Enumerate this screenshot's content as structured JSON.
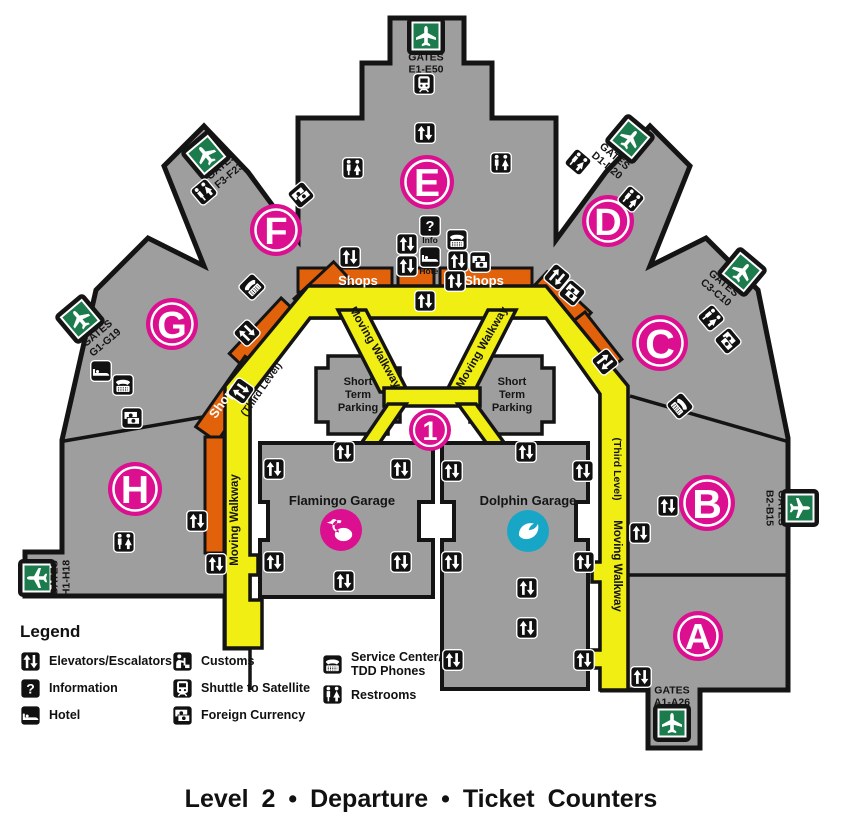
{
  "title": "Level 2 • Departure • Ticket Counters",
  "legend": {
    "heading": "Legend",
    "columns": [
      {
        "items": [
          {
            "label": "Elevators/Escalators",
            "icon": "elevators-escalators-icon",
            "ref": "#ic-elev"
          },
          {
            "label": "Information",
            "icon": "information-icon",
            "ref": "#ic-info"
          },
          {
            "label": "Hotel",
            "icon": "hotel-icon",
            "ref": "#ic-hotel"
          }
        ]
      },
      {
        "items": [
          {
            "label": "Customs",
            "icon": "customs-icon",
            "ref": "#ic-customs"
          },
          {
            "label": "Shuttle to Satellite",
            "icon": "shuttle-to-satellite-icon",
            "ref": "#ic-shuttle"
          },
          {
            "label": "Foreign Currency",
            "icon": "foreign-currency-icon",
            "ref": "#ic-currency"
          }
        ]
      },
      {
        "items": [
          {
            "label": "Service Center/\nTDD Phones",
            "icon": "service-center-tdd-phones-icon",
            "ref": "#ic-service"
          },
          {
            "label": "Restrooms",
            "icon": "restrooms-icon",
            "ref": "#ic-rest"
          }
        ]
      }
    ]
  },
  "map": {
    "colors": {
      "gray": "#9E9E9E",
      "outline": "#141414",
      "pink": "#DB0F8F",
      "gate_green": "#1B7B4D",
      "orange": "#E2610B",
      "yellow": "#F0EE12",
      "teal": "#17A6C6"
    },
    "plane_path": "M 0,-10 C 1.2,-10 1.8,-8.5 1.8,-6.5 L 1.8,-3 L 10,1.5 L 10,4 L 1.8,1.8 L 1.8,6.5 L 4.2,8.3 L 4.2,10.2 L 0,9 L -4.2,10.2 L -4.2,8.3 L -1.8,6.5 L -1.8,1.8 L -10,4 L -10,1.5 L -1.8,-3 L -1.8,-6.5 C -1.8,-8.5 -1.2,-10 0,-10 Z",
    "flamingo_path": "M -2,2.5 C -8,1.5 -10,-3 -7.5,-7 C -5.8,-9.6 -2,-10.6 0.6,-9.2 L -0.8,-6.6 C -3.2,-7.6 -5.4,-6.4 -6.2,-4.2 C -7,-2 -5.4,0 -2.4,0.4 Z M -6.9,-7.9 m -3.1,0 a 3.1,3.1 0 1 0 6.2,0 a 3.1,3.1 0 1 0 -6.2,0 M -9.6,-9 L -14.2,-7.2 L -9.4,-6.1 Z M 2.5,4.5 m -8.7,0 a 8.7,6.6 0 1 0 17.4,0 a 8.7,6.6 0 1 0 -17.4,0",
    "dolphin_path": "M -9,4.5 C -9.5,-3.5 -2.5,-9.5 6,-7.5 C 3,-5.8 1.3,-3.6 0.8,-0.8 C 5.8,-1.2 8.8,-3.8 9.8,-7.2 C 11.8,-1 8.2,6.2 1,7.8 C -3.6,8.8 -7.2,7.3 -9,4.5 Z",
    "gates": [
      {
        "id": "E",
        "word": "GATES",
        "range": "E1-E50",
        "fx": 426,
        "fy": 36,
        "frot": 0,
        "tx": 426,
        "ty": 66,
        "trot": 0,
        "plane": 0
      },
      {
        "id": "D",
        "word": "GATES",
        "range": "D1-D20",
        "fx": 630,
        "fy": 139,
        "frot": 40,
        "tx": 609,
        "ty": 163,
        "trot": 40,
        "plane": 0
      },
      {
        "id": "C",
        "word": "GATES",
        "range": "C3-C10",
        "fx": 742,
        "fy": 272,
        "frot": 40,
        "tx": 718,
        "ty": 290,
        "trot": 40,
        "plane": 0
      },
      {
        "id": "B",
        "word": "GATES",
        "range": "B2-B15",
        "fx": 800,
        "fy": 508,
        "frot": 0,
        "tx": 773,
        "ty": 508,
        "trot": 90,
        "plane": 90
      },
      {
        "id": "A",
        "word": "GATES",
        "range": "A1-A26",
        "fx": 672,
        "fy": 723,
        "frot": 0,
        "tx": 672,
        "ty": 699,
        "trot": 0,
        "plane": 0
      },
      {
        "id": "H",
        "word": "GATES",
        "range": "H1-H18",
        "fx": 37,
        "fy": 578,
        "frot": 0,
        "tx": 63,
        "ty": 578,
        "trot": -90,
        "plane": -90
      },
      {
        "id": "G",
        "word": "GATES",
        "range": "G1-G19",
        "fx": 80,
        "fy": 319,
        "frot": -40,
        "tx": 103,
        "ty": 340,
        "trot": -40,
        "plane": 0
      },
      {
        "id": "F",
        "word": "GATES",
        "range": "F3-F23",
        "fx": 206,
        "fy": 155,
        "frot": -40,
        "tx": 227,
        "ty": 173,
        "trot": -40,
        "plane": 0
      }
    ],
    "terminals": [
      {
        "letter": "A",
        "x": 698,
        "y": 636,
        "r": 25
      },
      {
        "letter": "B",
        "x": 707,
        "y": 503,
        "r": 28
      },
      {
        "letter": "C",
        "x": 660,
        "y": 343,
        "r": 28
      },
      {
        "letter": "D",
        "x": 608,
        "y": 221,
        "r": 26
      },
      {
        "letter": "E",
        "x": 427,
        "y": 182,
        "r": 27
      },
      {
        "letter": "F",
        "x": 276,
        "y": 230,
        "r": 26
      },
      {
        "letter": "G",
        "x": 172,
        "y": 324,
        "r": 26
      },
      {
        "letter": "H",
        "x": 135,
        "y": 489,
        "r": 27
      }
    ],
    "hub": {
      "label": "1",
      "x": 430,
      "y": 430,
      "r": 21
    },
    "garages": [
      {
        "name": "Flamingo Garage",
        "nx": 342,
        "ny": 505,
        "icon": "flamingo",
        "ix": 341,
        "iy": 530
      },
      {
        "name": "Dolphin Garage",
        "nx": 528,
        "ny": 505,
        "icon": "dolphin",
        "ix": 528,
        "iy": 531
      }
    ],
    "parking": {
      "lines": [
        "Short",
        "Term",
        "Parking"
      ],
      "centers": [
        [
          358,
          385
        ],
        [
          512,
          385
        ]
      ]
    },
    "labels": [
      {
        "t": "Shops",
        "x": 358,
        "y": 285,
        "c": "shops"
      },
      {
        "t": "Shops",
        "x": 484,
        "y": 285,
        "c": "shops"
      },
      {
        "t": "Shops",
        "x": 227,
        "y": 403,
        "r": -55,
        "c": "shops"
      },
      {
        "t": "Moving Walkway",
        "x": 372,
        "y": 349,
        "r": 60,
        "c": "walk"
      },
      {
        "t": "Moving Walkway",
        "x": 485,
        "y": 349,
        "r": -60,
        "c": "walk"
      },
      {
        "t": "Moving Walkway",
        "x": 238,
        "y": 520,
        "r": -90,
        "c": "walk"
      },
      {
        "t": "Moving Walkway",
        "x": 614,
        "y": 566,
        "r": 90,
        "c": "walk"
      },
      {
        "t": "(Third Level)",
        "x": 264,
        "y": 391,
        "r": -55,
        "c": "third"
      },
      {
        "t": "(Third Level)",
        "x": 614,
        "y": 469,
        "r": 90,
        "c": "third"
      },
      {
        "t": "Info",
        "x": 430,
        "y": 243,
        "c": "tiny"
      },
      {
        "t": "Hotel",
        "x": 430,
        "y": 274,
        "c": "tiny"
      }
    ],
    "icons": [
      {
        "t": "elev",
        "x": 425,
        "y": 133
      },
      {
        "t": "elev",
        "x": 425,
        "y": 301
      },
      {
        "t": "elev",
        "x": 407,
        "y": 244
      },
      {
        "t": "elev",
        "x": 407,
        "y": 266
      },
      {
        "t": "elev",
        "x": 458,
        "y": 261
      },
      {
        "t": "elev",
        "x": 455,
        "y": 281
      },
      {
        "t": "elev",
        "x": 350,
        "y": 257
      },
      {
        "t": "elev",
        "x": 557,
        "y": 277,
        "r": 40
      },
      {
        "t": "elev",
        "x": 605,
        "y": 362,
        "r": 52
      },
      {
        "t": "elev",
        "x": 241,
        "y": 391,
        "r": -55
      },
      {
        "t": "elev",
        "x": 247,
        "y": 333,
        "r": -45
      },
      {
        "t": "elev",
        "x": 197,
        "y": 521
      },
      {
        "t": "elev",
        "x": 216,
        "y": 564
      },
      {
        "t": "elev",
        "x": 668,
        "y": 506
      },
      {
        "t": "elev",
        "x": 640,
        "y": 533
      },
      {
        "t": "elev",
        "x": 641,
        "y": 677
      },
      {
        "t": "elev",
        "x": 344,
        "y": 452
      },
      {
        "t": "elev",
        "x": 274,
        "y": 469
      },
      {
        "t": "elev",
        "x": 401,
        "y": 469
      },
      {
        "t": "elev",
        "x": 274,
        "y": 562
      },
      {
        "t": "elev",
        "x": 401,
        "y": 562
      },
      {
        "t": "elev",
        "x": 344,
        "y": 581
      },
      {
        "t": "elev",
        "x": 526,
        "y": 452
      },
      {
        "t": "elev",
        "x": 452,
        "y": 471
      },
      {
        "t": "elev",
        "x": 583,
        "y": 471
      },
      {
        "t": "elev",
        "x": 452,
        "y": 562
      },
      {
        "t": "elev",
        "x": 584,
        "y": 562
      },
      {
        "t": "elev",
        "x": 527,
        "y": 588
      },
      {
        "t": "elev",
        "x": 527,
        "y": 628
      },
      {
        "t": "elev",
        "x": 453,
        "y": 660
      },
      {
        "t": "elev",
        "x": 584,
        "y": 660
      },
      {
        "t": "rest",
        "x": 353,
        "y": 168
      },
      {
        "t": "rest",
        "x": 501,
        "y": 163
      },
      {
        "t": "rest",
        "x": 578,
        "y": 162,
        "r": 40
      },
      {
        "t": "rest",
        "x": 631,
        "y": 199,
        "r": 40
      },
      {
        "t": "rest",
        "x": 204,
        "y": 192,
        "r": -40
      },
      {
        "t": "rest",
        "x": 711,
        "y": 318,
        "r": 50
      },
      {
        "t": "rest",
        "x": 124,
        "y": 542
      },
      {
        "t": "info",
        "x": 430,
        "y": 226
      },
      {
        "t": "hotel",
        "x": 430,
        "y": 257
      },
      {
        "t": "hotel",
        "x": 101,
        "y": 371
      },
      {
        "t": "service",
        "x": 457,
        "y": 240
      },
      {
        "t": "service",
        "x": 252,
        "y": 287,
        "r": -45
      },
      {
        "t": "service",
        "x": 680,
        "y": 406,
        "r": 50
      },
      {
        "t": "service",
        "x": 123,
        "y": 385
      },
      {
        "t": "currency",
        "x": 480,
        "y": 262
      },
      {
        "t": "currency",
        "x": 572,
        "y": 293,
        "r": 40
      },
      {
        "t": "currency",
        "x": 301,
        "y": 195,
        "r": -40
      },
      {
        "t": "currency",
        "x": 728,
        "y": 341,
        "r": 50
      },
      {
        "t": "currency",
        "x": 132,
        "y": 418
      },
      {
        "t": "shuttle",
        "x": 424,
        "y": 84
      }
    ]
  }
}
